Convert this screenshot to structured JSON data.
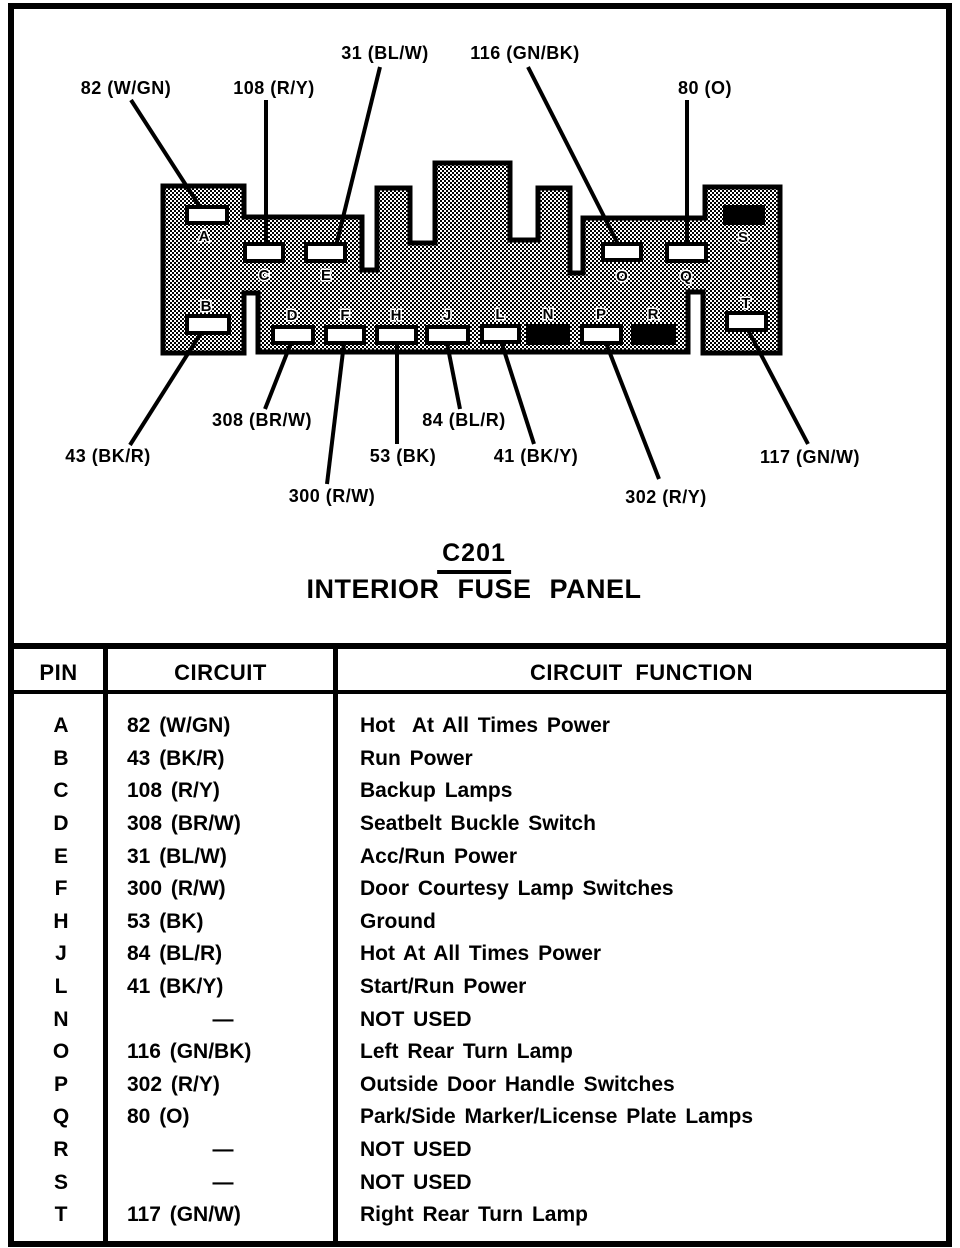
{
  "colors": {
    "ink": "#000000",
    "paper": "#ffffff"
  },
  "diagram": {
    "connector_id": "C201",
    "connector_name": "INTERIOR FUSE PANEL",
    "callouts": [
      {
        "text": "82 (W/GN)"
      },
      {
        "text": "108 (R/Y)"
      },
      {
        "text": "31 (BL/W)"
      },
      {
        "text": "116 (GN/BK)"
      },
      {
        "text": "80 (O)"
      },
      {
        "text": "43 (BK/R)"
      },
      {
        "text": "308 (BR/W)"
      },
      {
        "text": "300 (R/W)"
      },
      {
        "text": "53 (BK)"
      },
      {
        "text": "84 (BL/R)"
      },
      {
        "text": "41 (BK/Y)"
      },
      {
        "text": "302 (R/Y)"
      },
      {
        "text": "117 (GN/W)"
      }
    ],
    "pins": [
      {
        "letter": "A",
        "used": true
      },
      {
        "letter": "B",
        "used": true
      },
      {
        "letter": "C",
        "used": true
      },
      {
        "letter": "D",
        "used": true
      },
      {
        "letter": "E",
        "used": true
      },
      {
        "letter": "F",
        "used": true
      },
      {
        "letter": "H",
        "used": true
      },
      {
        "letter": "J",
        "used": true
      },
      {
        "letter": "L",
        "used": true
      },
      {
        "letter": "N",
        "used": false
      },
      {
        "letter": "O",
        "used": true
      },
      {
        "letter": "P",
        "used": true
      },
      {
        "letter": "Q",
        "used": true
      },
      {
        "letter": "R",
        "used": false
      },
      {
        "letter": "S",
        "used": false
      },
      {
        "letter": "T",
        "used": true
      }
    ]
  },
  "table": {
    "headers": {
      "pin": "PIN",
      "circuit": "CIRCUIT",
      "function": "CIRCUIT FUNCTION"
    },
    "rows": [
      {
        "pin": "A",
        "circuit": "82 (W/GN)",
        "function": "Hot  At All Times Power"
      },
      {
        "pin": "B",
        "circuit": "43 (BK/R)",
        "function": "Run Power"
      },
      {
        "pin": "C",
        "circuit": "108 (R/Y)",
        "function": "Backup Lamps"
      },
      {
        "pin": "D",
        "circuit": "308 (BR/W)",
        "function": "Seatbelt Buckle Switch"
      },
      {
        "pin": "E",
        "circuit": "31 (BL/W)",
        "function": "Acc/Run Power"
      },
      {
        "pin": "F",
        "circuit": "300 (R/W)",
        "function": "Door Courtesy Lamp Switches"
      },
      {
        "pin": "H",
        "circuit": "53 (BK)",
        "function": "Ground"
      },
      {
        "pin": "J",
        "circuit": "84 (BL/R)",
        "function": "Hot At All Times Power"
      },
      {
        "pin": "L",
        "circuit": "41 (BK/Y)",
        "function": "Start/Run Power"
      },
      {
        "pin": "N",
        "circuit": "—",
        "function": "NOT USED"
      },
      {
        "pin": "O",
        "circuit": "116 (GN/BK)",
        "function": "Left Rear Turn Lamp"
      },
      {
        "pin": "P",
        "circuit": "302 (R/Y)",
        "function": "Outside Door Handle Switches"
      },
      {
        "pin": "Q",
        "circuit": "80 (O)",
        "function": "Park/Side Marker/License Plate Lamps"
      },
      {
        "pin": "R",
        "circuit": "—",
        "function": "NOT USED"
      },
      {
        "pin": "S",
        "circuit": "—",
        "function": "NOT USED"
      },
      {
        "pin": "T",
        "circuit": "117 (GN/W)",
        "function": "Right Rear Turn Lamp"
      }
    ]
  }
}
